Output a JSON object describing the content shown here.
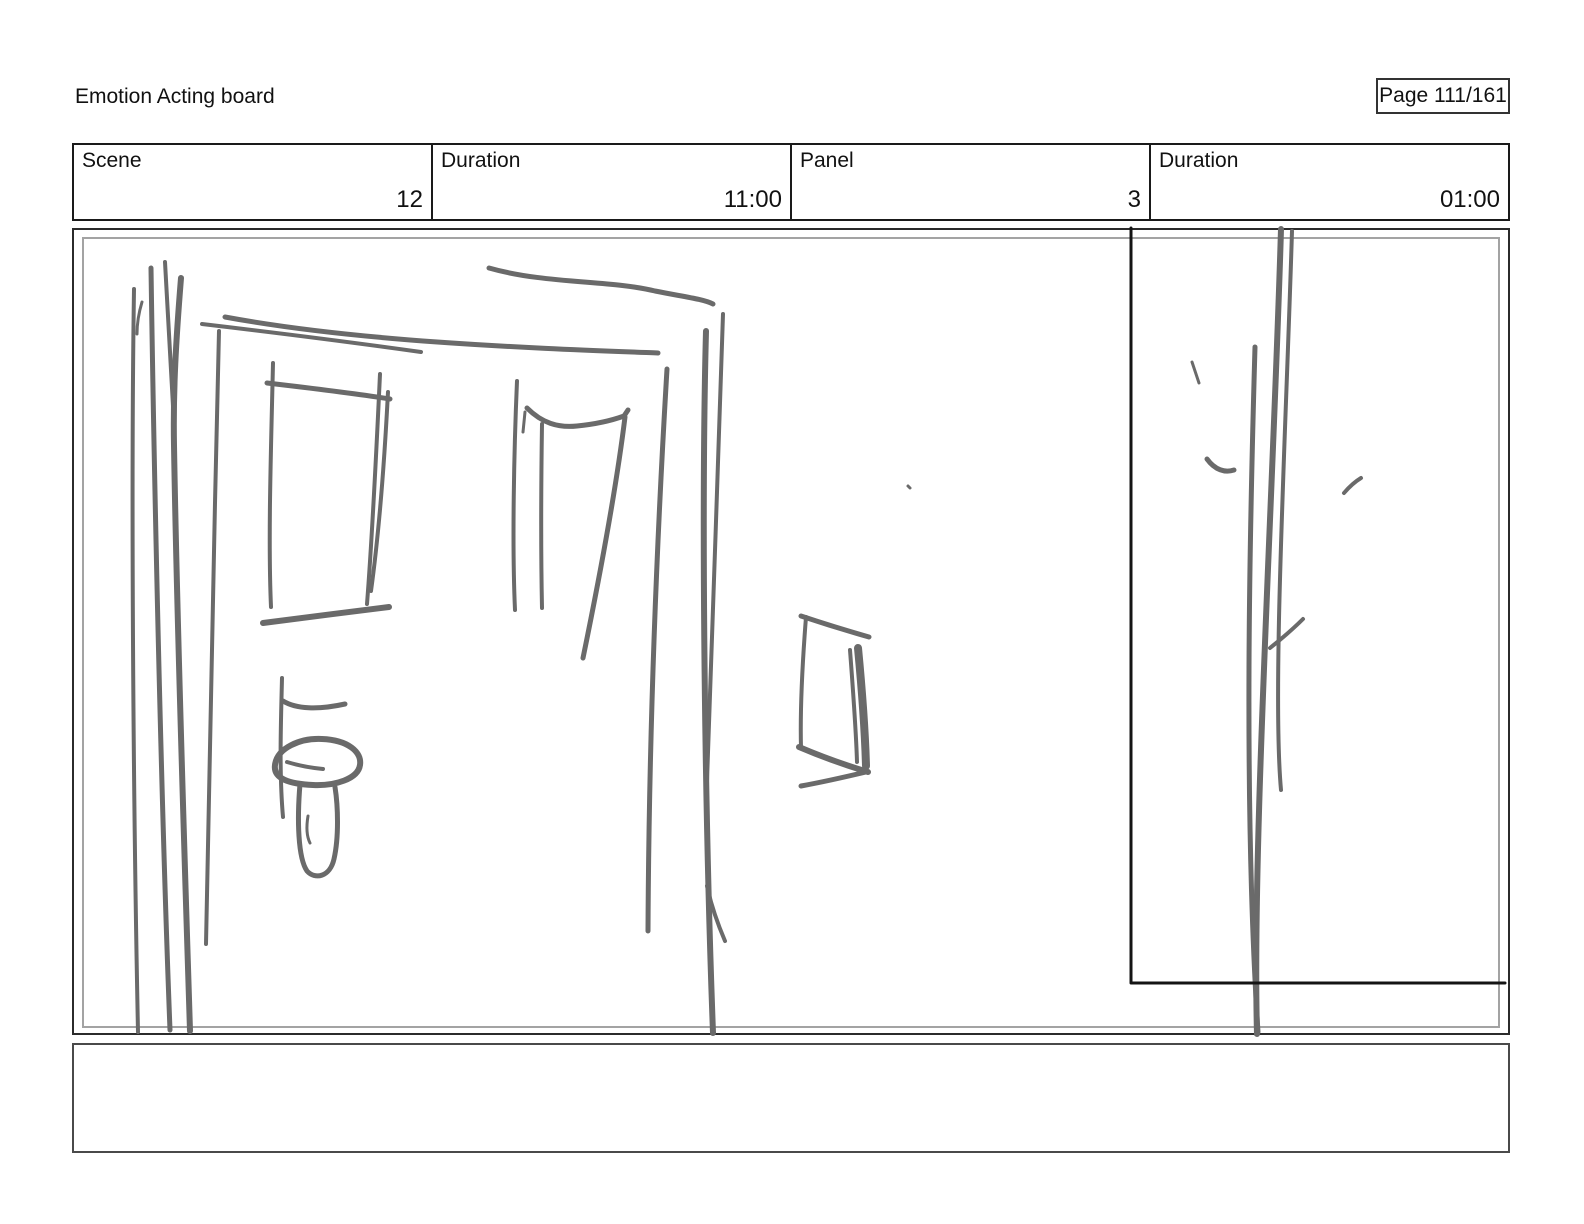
{
  "header": {
    "title": "Emotion Acting board",
    "page_label": "Page 111/161"
  },
  "info_table": {
    "cells": [
      {
        "label": "Scene",
        "value": "12"
      },
      {
        "label": "Duration",
        "value": "11:00"
      },
      {
        "label": "Panel",
        "value": "3"
      },
      {
        "label": "Duration",
        "value": "01:00"
      }
    ]
  },
  "notes": {
    "text": ""
  },
  "sketch": {
    "stroke_color": "#6a6a6a",
    "overlay_color": "#141414",
    "frame_outer_color": "#2b2b2b",
    "frame_inner_color": "#a3a3a3",
    "paths": [
      {
        "d": "M134,289 C131,480 133,790 138,1032",
        "w": 4
      },
      {
        "d": "M142,302 C139,312 137,322 137,334",
        "w": 3
      },
      {
        "d": "M151,268 C154,470 161,800 170,1030",
        "w": 5
      },
      {
        "d": "M165,262 C168,320 171,375 174,424",
        "w": 4
      },
      {
        "d": "M181,278 C176,340 173,390 174,445 C177,630 185,870 190,1031",
        "w": 6
      },
      {
        "d": "M219,331 C214,540 209,770 206,944",
        "w": 4
      },
      {
        "d": "M202,324 C270,332 350,342 421,352",
        "w": 4
      },
      {
        "d": "M225,317 C360,342 530,348 658,353",
        "w": 5
      },
      {
        "d": "M489,268 C545,284 610,280 655,291 C685,297 703,299 713,304",
        "w": 5
      },
      {
        "d": "M667,369 C658,520 649,720 648,931",
        "w": 5
      },
      {
        "d": "M706,331 C701,520 705,820 713,1033",
        "w": 6
      },
      {
        "d": "M723,314 C719,460 711,640 707,781",
        "w": 4
      },
      {
        "d": "M707,886 C712,909 719,927 725,941",
        "w": 4
      },
      {
        "d": "M273,363 C271,450 268,540 271,607",
        "w": 4
      },
      {
        "d": "M267,383 C310,388 352,393 390,399",
        "w": 5
      },
      {
        "d": "M380,374 C376,460 372,540 367,604",
        "w": 4
      },
      {
        "d": "M388,392 C384,470 378,540 371,591",
        "w": 4
      },
      {
        "d": "M263,623 C300,618 350,612 389,607",
        "w": 6
      },
      {
        "d": "M282,678 C281,720 279,772 283,817",
        "w": 4
      },
      {
        "d": "M283,701 C296,709 318,710 345,704",
        "w": 5
      },
      {
        "d": "M275,765 C277,748 300,738 322,739 C348,740 362,752 360,765 C358,779 335,786 313,785 C290,784 273,779 275,765",
        "w": 6
      },
      {
        "d": "M287,762 C300,766 312,768 323,769",
        "w": 4
      },
      {
        "d": "M300,784 C297,820 298,858 307,871 C315,880 330,877 334,859 C339,837 338,806 335,787",
        "w": 5
      },
      {
        "d": "M308,816 C306,828 307,837 310,843",
        "w": 3
      },
      {
        "d": "M517,381 C514,450 512,545 515,610",
        "w": 4
      },
      {
        "d": "M525,412 L523,432",
        "w": 3
      },
      {
        "d": "M542,424 C541,490 541,560 542,608",
        "w": 4
      },
      {
        "d": "M527,408 C542,423 558,428 577,426 C597,424 613,420 624,416 L628,410",
        "w": 5
      },
      {
        "d": "M625,417 C616,490 599,580 583,658",
        "w": 5
      },
      {
        "d": "M806,617 C802,668 800,710 801,748",
        "w": 4
      },
      {
        "d": "M801,616 C825,624 848,631 869,637",
        "w": 5
      },
      {
        "d": "M850,650 C853,690 856,728 857,762",
        "w": 4
      },
      {
        "d": "M858,648 C862,690 865,730 866,766",
        "w": 8
      },
      {
        "d": "M799,747 C820,756 845,765 868,772",
        "w": 6
      },
      {
        "d": "M801,786 C823,782 845,777 866,772",
        "w": 5
      },
      {
        "d": "M908,486 L910,488",
        "w": 3
      },
      {
        "d": "M1255,347 C1250,520 1243,800 1258,1032",
        "w": 5
      },
      {
        "d": "M1281,229 C1273,500 1252,850 1257,1034",
        "w": 6
      },
      {
        "d": "M1292,231 C1286,430 1272,690 1281,790",
        "w": 4
      },
      {
        "d": "M1303,619 C1292,630 1280,640 1270,648",
        "w": 4
      },
      {
        "d": "M1192,362 L1199,383",
        "w": 3
      },
      {
        "d": "M1207,459 C1215,470 1225,473 1234,470",
        "w": 5
      },
      {
        "d": "M1344,493 C1350,486 1356,481 1361,478",
        "w": 4
      }
    ],
    "overlay": [
      {
        "d": "M1131,228 L1131,983 L1505,983",
        "w": 3
      }
    ]
  }
}
